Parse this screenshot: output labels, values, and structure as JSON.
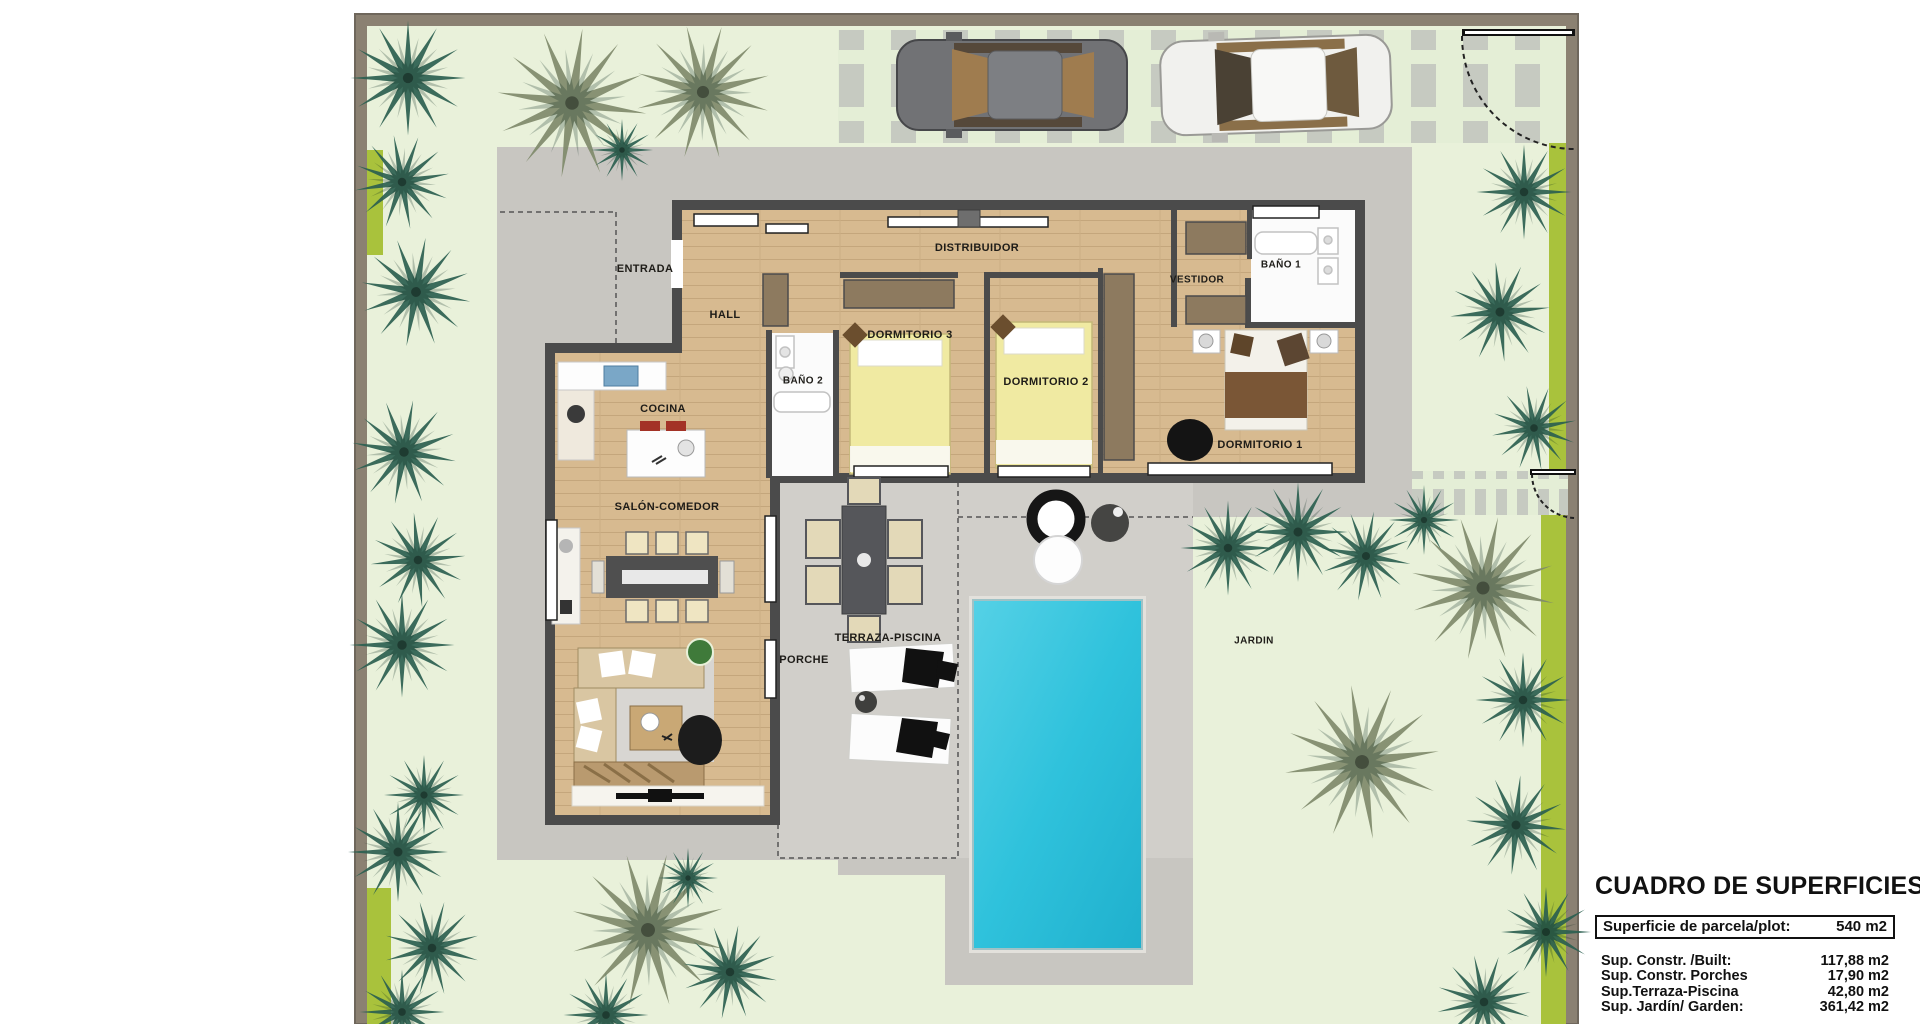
{
  "plan": {
    "rooms": {
      "entrada": {
        "label": "ENTRADA"
      },
      "hall": {
        "label": "HALL"
      },
      "distribuidor": {
        "label": "DISTRIBUIDOR"
      },
      "dormitorio3": {
        "label": "DORMITORIO 3"
      },
      "bano2": {
        "label": "BAÑO 2"
      },
      "dormitorio2": {
        "label": "DORMITORIO 2"
      },
      "vestidor": {
        "label": "VESTIDOR"
      },
      "bano1": {
        "label": "BAÑO 1"
      },
      "dormitorio1": {
        "label": "DORMITORIO 1"
      },
      "cocina": {
        "label": "COCINA"
      },
      "salon": {
        "label": "SALÓN-COMEDOR"
      },
      "porche": {
        "label": "PORCHE"
      },
      "terraza": {
        "label": "TERRAZA-PISCINA"
      },
      "jardin": {
        "label": "JARDIN"
      }
    }
  },
  "surfaces_table": {
    "title": "CUADRO DE SUPERFICIES",
    "parcel": {
      "label": "Superficie de parcela/plot:",
      "value": "540 m2"
    },
    "rows": [
      {
        "label": "Sup. Constr. /Built:",
        "value": "117,88 m2"
      },
      {
        "label": "Sup. Constr. Porches",
        "value": "17,90 m2"
      },
      {
        "label": "Sup.Terraza-Piscina",
        "value": "42,80 m2"
      },
      {
        "label": "Sup. Jardín/ Garden:",
        "value": "361,42 m2"
      }
    ]
  },
  "colors": {
    "garden_green": "#e9f1da",
    "hedge_lime": "#a9c23c",
    "boundary_wall": "#8b8172",
    "driveway_gray": "#c8c6c1",
    "porch_gray": "#d1cfca",
    "house_wall": "#4b4b4b",
    "wood_floor": "#d7ba90",
    "pool_turquoise": "#2fc2dc",
    "palm_teal": "#2b5f50",
    "palm_olive": "#7f8a6b",
    "bed_yellow": "#f0eaa2",
    "bed_brown": "#7a5636"
  }
}
